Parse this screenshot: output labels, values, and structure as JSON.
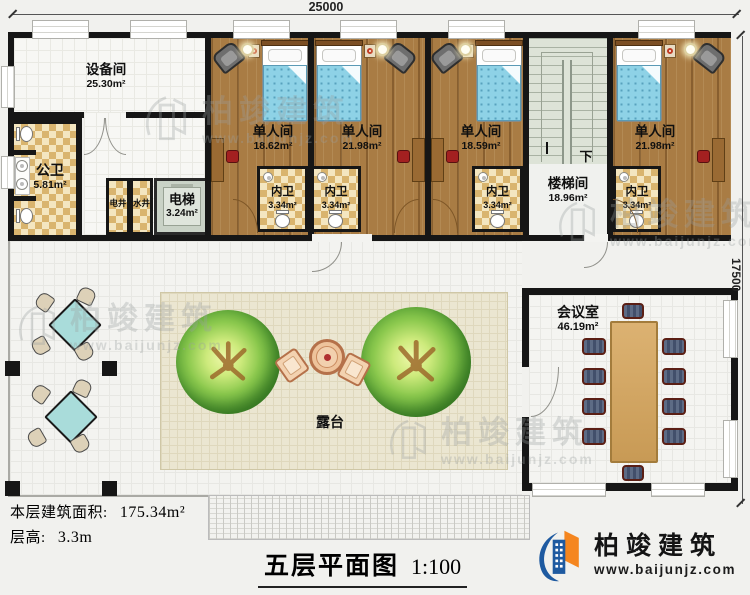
{
  "plan": {
    "dim_top": "25000",
    "dim_right": "17500",
    "stair_down": "下",
    "rooms": {
      "equipment": {
        "name": "设备间",
        "area": "25.30m²"
      },
      "public_wc": {
        "name": "公卫",
        "area": "5.81m²"
      },
      "electric_shaft": {
        "name": "电井"
      },
      "water_shaft": {
        "name": "水井"
      },
      "elevator": {
        "name": "电梯",
        "area": "3.24m²"
      },
      "single1": {
        "name": "单人间",
        "area": "18.62m²"
      },
      "single2": {
        "name": "单人间",
        "area": "21.98m²"
      },
      "single3": {
        "name": "单人间",
        "area": "18.59m²"
      },
      "single4": {
        "name": "单人间",
        "area": "21.98m²"
      },
      "ensuite1": {
        "name": "内卫",
        "area": "3.34m²"
      },
      "ensuite2": {
        "name": "内卫",
        "area": "3.34m²"
      },
      "ensuite3": {
        "name": "内卫",
        "area": "3.34m²"
      },
      "ensuite4": {
        "name": "内卫",
        "area": "3.34m²"
      },
      "stair_hall": {
        "name": "楼梯间",
        "area": "18.96m²"
      },
      "meeting": {
        "name": "会议室",
        "area": "46.19m²"
      },
      "terrace": {
        "name": "露台"
      }
    }
  },
  "footer": {
    "area_label": "本层建筑面积:",
    "area_value": "175.34m²",
    "height_label": "层高:",
    "height_value": "3.3m",
    "title": "五层平面图",
    "scale": "1:100"
  },
  "brand": {
    "name": "柏竣建筑",
    "site": "www.baijunjz.com"
  },
  "watermark": {
    "name": "柏竣建筑",
    "site": "www.baijunjz.com"
  },
  "colors": {
    "wall": "#161616",
    "accent_blue": "#1e5aa0",
    "accent_orange": "#f5861f",
    "wood": "#a97c44"
  }
}
